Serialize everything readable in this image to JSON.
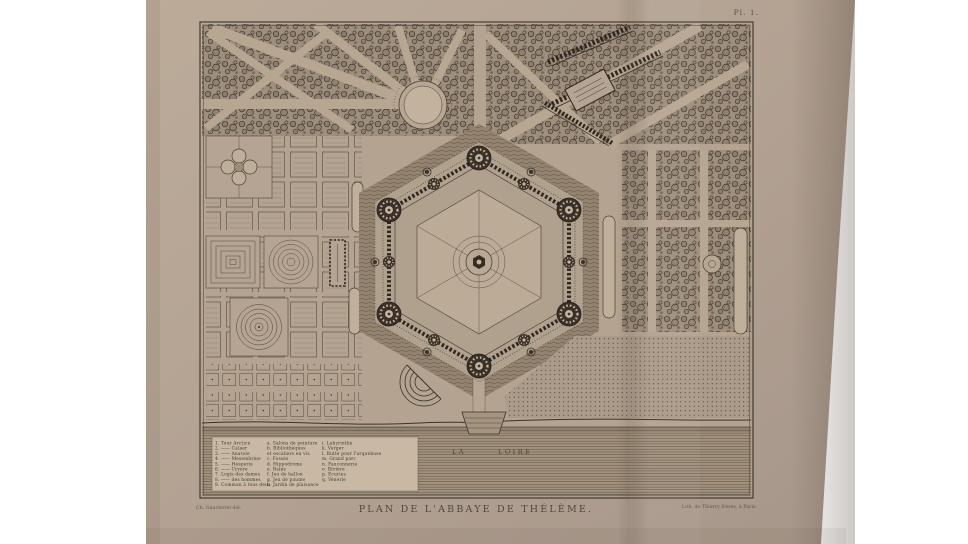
{
  "page": {
    "background": "#ffffff",
    "paper_color": "#b2a192",
    "ink_color": "#3f372c",
    "wash_color": "#93836f",
    "legend_box_color": "#c9b9a4"
  },
  "plate": {
    "number_label": "Pl. 1.",
    "title": "PLAN DE L'ABBAYE DE THÉLÈME.",
    "artist_credit": "Ch. Gaucherel del.",
    "printer_credit": "Lith. de Thierry frères, à Paris.",
    "river_label_1": "LA",
    "river_label_2": "LOIRE"
  },
  "legend": {
    "col1": [
      "1. Tour Arctice",
      "2. —— Calaer",
      "3. —— Anatole",
      "4. —— Mesembrine",
      "5. —— Hesperie",
      "6. —— Cryere",
      "7. Logis des dames",
      "8. —— des hommes",
      "9. Commun à tous deux"
    ],
    "col2": [
      "a. Salons de peinture",
      "b. Bibliothèques",
      "    et escaliers en vis",
      "c. Fossés",
      "d. Hippodrome",
      "e. Bains",
      "f. Jeu de ballon",
      "g. Jeu de paume",
      "h. Jardin de plaisance"
    ],
    "col3": [
      "i. Labyrinthe",
      "k. Verger",
      "l. Butte pour l'arquebuse",
      "m. Grand parc",
      "n. Fauconnerie",
      "o. Rivière",
      "p. Écuries",
      "q. Vénerie"
    ]
  }
}
